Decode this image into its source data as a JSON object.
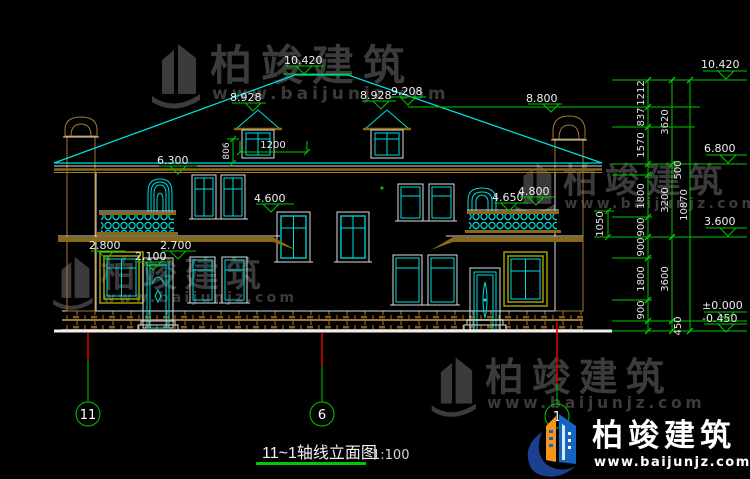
{
  "brand": {
    "name": "柏竣建筑",
    "site": "www.baijunjz.com"
  },
  "title": {
    "text": "11~1轴线立面图",
    "scale": "1:100"
  },
  "axes": {
    "a11": "11",
    "a6": "6",
    "a1": "1"
  },
  "marks": {
    "ridge": "10.420",
    "dormer_left": "8.928",
    "dormer_right": "8.928",
    "roof_right": "9.208",
    "chimney_right": "8.800",
    "eaves": "6.300",
    "floor2_center": "4.600",
    "balcony_rail": "4.650",
    "balcony_top": "4.800",
    "window_head_left": "2.800",
    "door_head": "2.700",
    "window_sill": "2.100"
  },
  "levels": {
    "top": "10.420",
    "mid2": "6.800",
    "mid1": "3.600",
    "zero": "±0.000",
    "neg": "-0.450"
  },
  "dims": {
    "dormer_width": "1200",
    "dormer_height": "806",
    "railing_height": "1050"
  },
  "chain": {
    "segments": [
      "1212",
      "837",
      "1570",
      "500",
      "1800",
      "900",
      "900",
      "1800",
      "900",
      "450"
    ],
    "groups": [
      "3620",
      "3200",
      "3600"
    ],
    "total": "10870"
  },
  "colors": {
    "background": "#000000",
    "line_cyan": "#00dcdc",
    "line_green": "#00c800",
    "line_red": "#d40000",
    "line_white": "#dddddd",
    "stone_tan": "#a5792b",
    "frame_olive": "#a8a800",
    "watermark_gray": "#3b3b3b",
    "logo_blue": "#1565c0",
    "logo_orange": "#f7941d"
  }
}
